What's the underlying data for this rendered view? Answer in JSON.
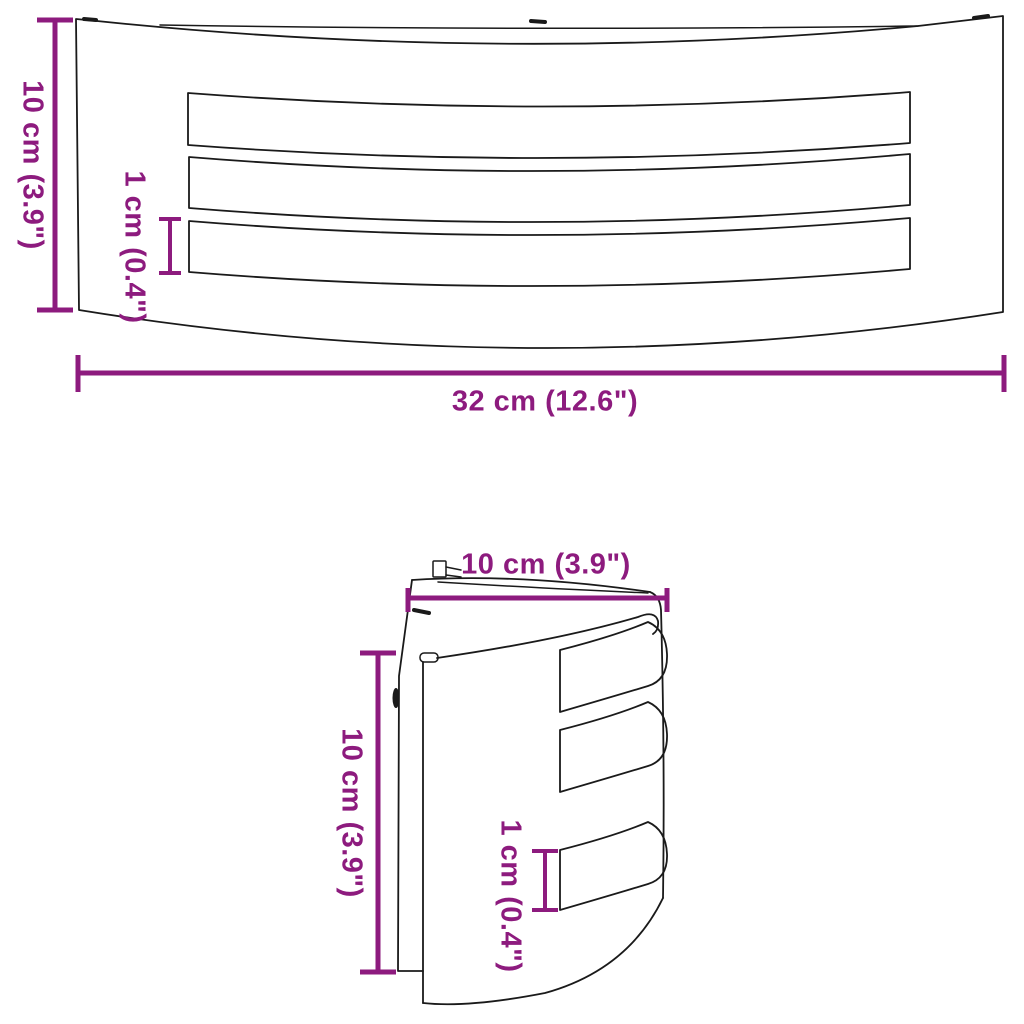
{
  "diagram": {
    "type": "product-dimension-drawing",
    "product": "curved wall light with louvre slots",
    "colors": {
      "accent": "#8d1b7e",
      "outline": "#1a1a1a",
      "background": "#ffffff"
    },
    "front_view": {
      "height_label": "10 cm (3.9\")",
      "slot_height_label": "1 cm (0.4\")",
      "width_label": "32 cm (12.6\")"
    },
    "side_view": {
      "depth_label": "10 cm (3.9\")",
      "height_label": "10 cm (3.9\")",
      "slot_height_label": "1 cm (0.4\")"
    }
  }
}
